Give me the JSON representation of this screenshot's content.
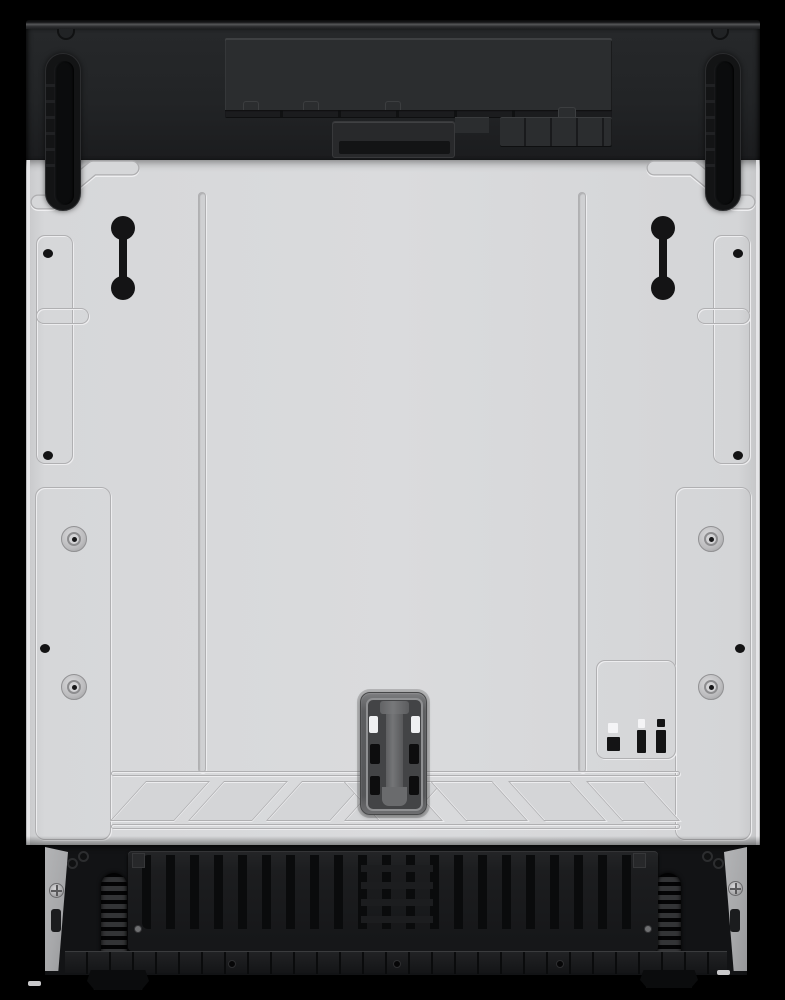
{
  "scene": {
    "description": "Front view product photo of a fully-integrated built-in dishwasher door assembly on a black background. No visible text anywhere in the image.",
    "background_color": "#000000"
  },
  "colors": {
    "bg": "#000000",
    "band": "#212325",
    "recess": "#2b2d2f",
    "door": "#d6d7d9",
    "groove": "#b0b0b2",
    "ink": "#141415",
    "latch-body": "#565759",
    "base": "#121315",
    "plate": "#1c1d1f",
    "wedge": "#a7a8aa"
  },
  "parts": {
    "appliance": {
      "label": "Built-in dishwasher front assembly"
    },
    "top_band": {
      "label": "Black top control band",
      "recess_label": "Recessed control-electronics panel",
      "center_box_label": "Central detergent/handle recess box",
      "hinge_left_label": "Left door hinge track",
      "hinge_right_label": "Right door hinge track",
      "notch_count": 2,
      "tab_count": 3
    },
    "door": {
      "label": "Gray panel-ready mounting door",
      "zigzag_label": "Embossed step groove (top corners)",
      "seam_label": "Vertical embossed seam",
      "seam_count": 2,
      "dumbbell_label": "Keyhole mounting slot (dumbbell shaped)",
      "dumbbell_count": 2,
      "side_hole_count": 6,
      "screw_label": "Panel mounting screw",
      "screw_count": 4,
      "latch_label": "Door latch receiver",
      "indicator_label": "Molded marking box (lower right)",
      "hatch_label": "Diagonal stiffening hatch band",
      "hatch_parallelograms_left": 3,
      "hatch_parallelograms_right": 3
    },
    "base": {
      "label": "Black kick-plate base",
      "plate_label": "Ribbed vent plate",
      "rib_spacing_px": 24,
      "coil_label": "Door spring coil",
      "coil_count": 2,
      "wedge_label": "Side mounting wedge (gray)",
      "wedge_screw_count": 2,
      "rail_label": "Bottom support rail",
      "rail_hole_count": 3,
      "feet_count": 2
    }
  }
}
